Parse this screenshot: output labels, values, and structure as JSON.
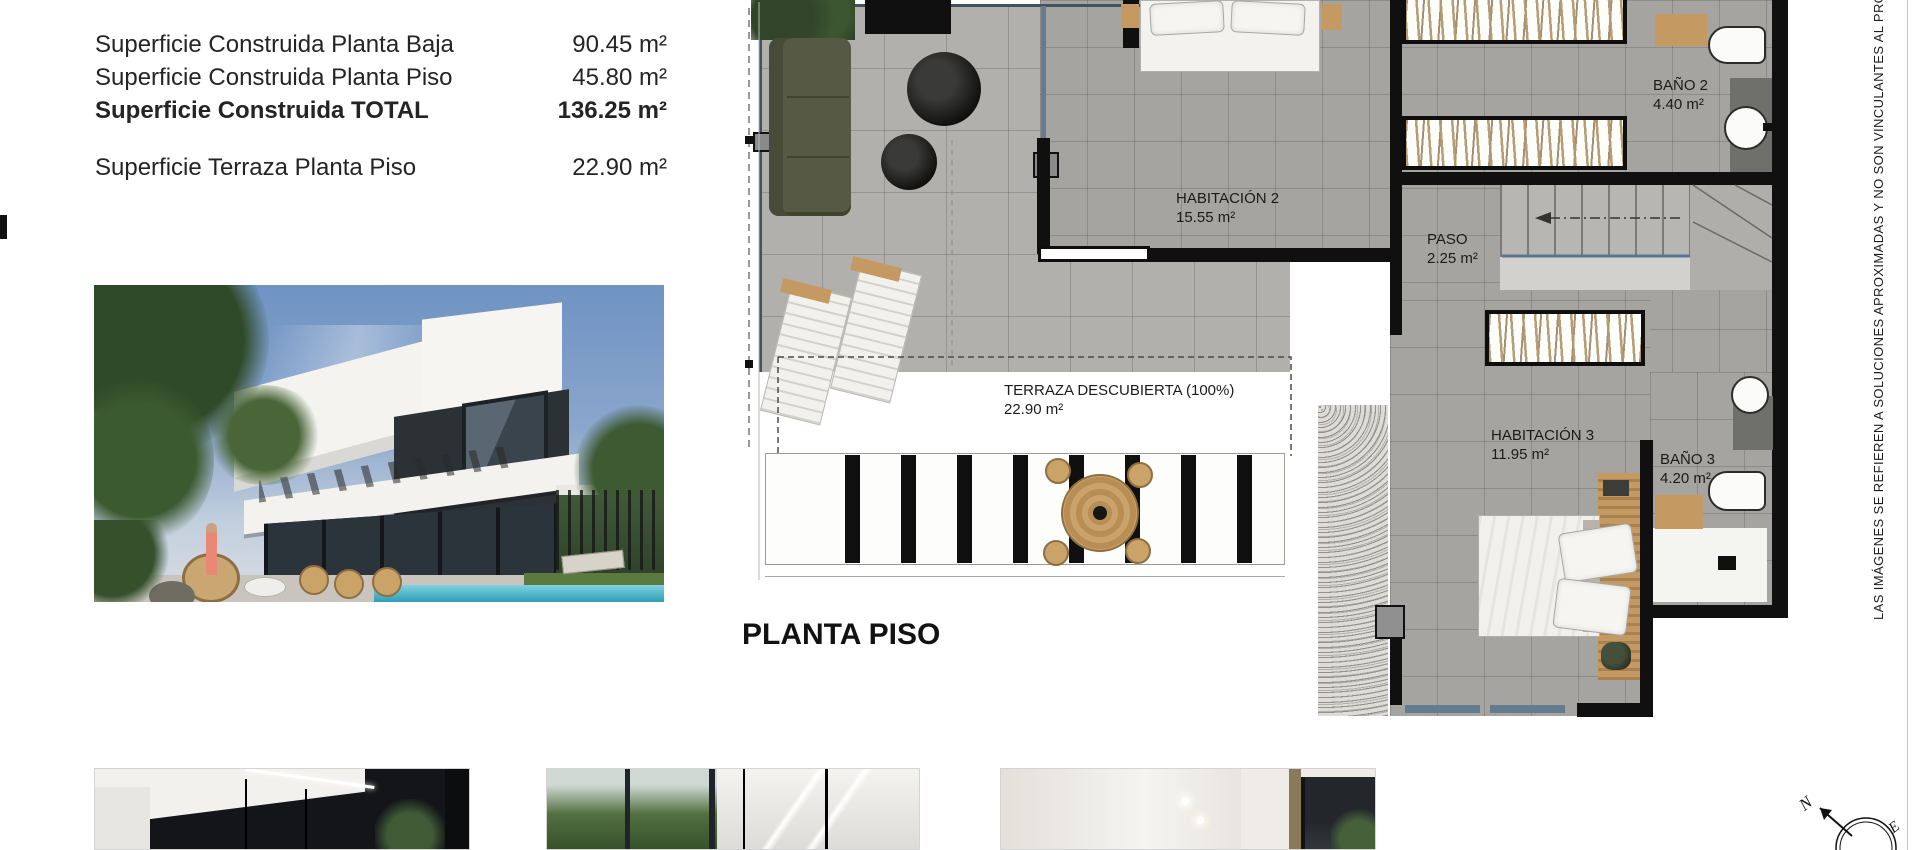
{
  "surface_table": {
    "rows": [
      {
        "label": "Superficie Construida Planta Baja",
        "value": "90.45 m²"
      },
      {
        "label": "Superficie Construida Planta Piso",
        "value": "45.80 m²"
      },
      {
        "label": "Superficie Construida TOTAL",
        "value": "136.25 m²"
      },
      {
        "label": "Superficie Terraza Planta Piso",
        "value": "22.90 m²"
      }
    ]
  },
  "floor_plan": {
    "title": "PLANTA PISO",
    "rooms": [
      {
        "name": "HABITACIÓN 2",
        "area": "15.55 m²"
      },
      {
        "name": "PASO",
        "area": "2.25 m²"
      },
      {
        "name": "BAÑO 2",
        "area": "4.40 m²"
      },
      {
        "name": "TERRAZA DESCUBIERTA (100%)",
        "area": "22.90 m²"
      },
      {
        "name": "HABITACIÓN 3",
        "area": "11.95 m²"
      },
      {
        "name": "BAÑO 3",
        "area": "4.20 m²"
      }
    ]
  },
  "disclaimer": "LAS IMÁGENES SE REFIEREN A SOLUCIONES APROXIMADAS Y NO SON VINCULANTES AL PROY",
  "compass": {
    "north": "N",
    "east": "E"
  },
  "colors": {
    "wall": "#101010",
    "floor_interior": "#a6a4a1",
    "floor_terrace": "#b2b0ac",
    "glazing": "#647b90",
    "wood": "#c49a62",
    "pool": "#49b4cc"
  }
}
